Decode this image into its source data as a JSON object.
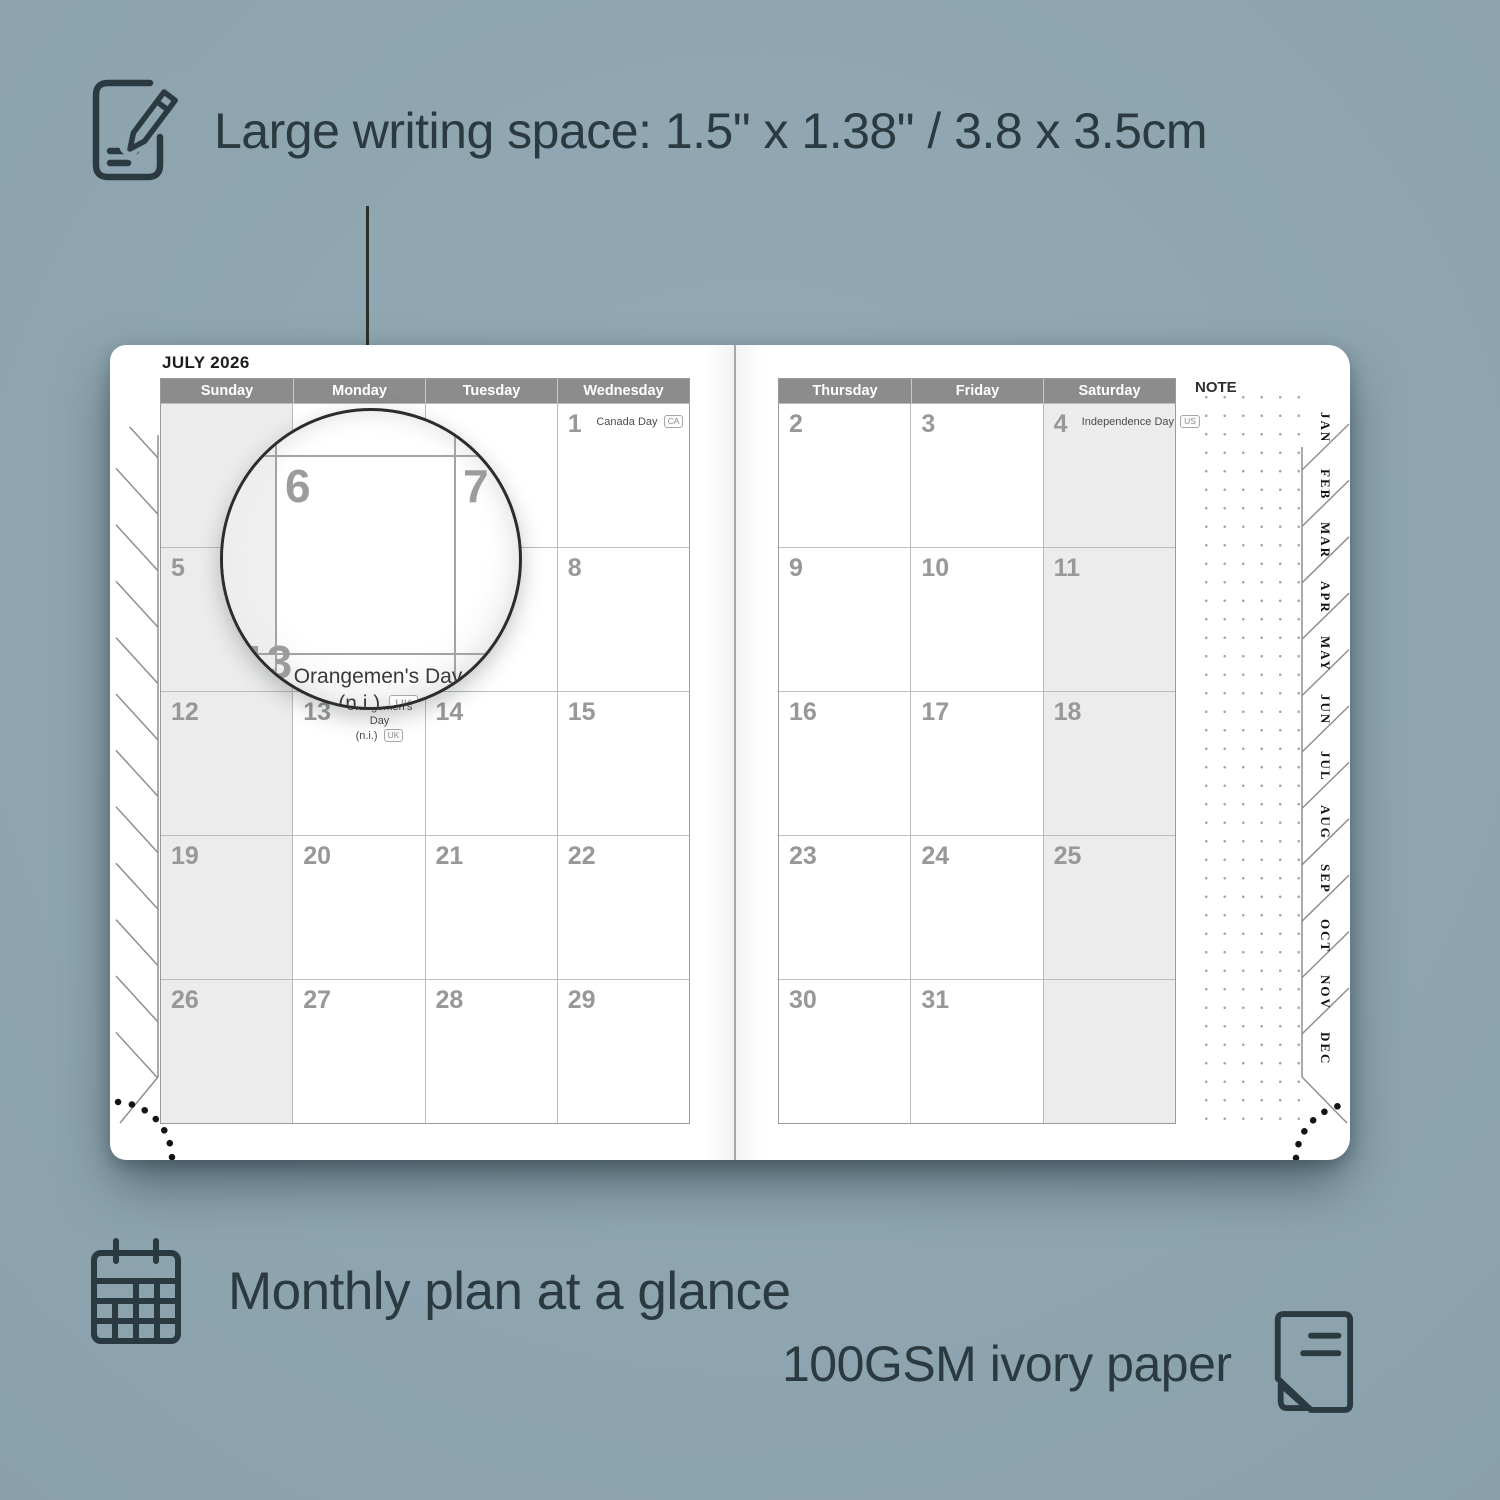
{
  "background_color": "#8ea5b0",
  "callouts": {
    "writing_space_label": "Large writing space: 1.5\" x 1.38\" / 3.8 x 3.5cm",
    "monthly_plan_label": "Monthly plan at a glance",
    "paper_label": "100GSM ivory paper"
  },
  "planner": {
    "month_title": "JULY 2026",
    "note_label": "NOTE",
    "month_tabs": [
      "JAN",
      "FEB",
      "MAR",
      "APR",
      "MAY",
      "JUN",
      "JUL",
      "AUG",
      "SEP",
      "OCT",
      "NOV",
      "DEC"
    ],
    "left_page": {
      "headers": [
        "Sunday",
        "Monday",
        "Tuesday",
        "Wednesday"
      ],
      "shaded_column": 0,
      "rows": [
        [
          null,
          null,
          null,
          {
            "d": "1",
            "holiday": "Canada Day",
            "badge": "CA",
            "layout": "inline"
          }
        ],
        [
          "5",
          "6",
          "7",
          "8"
        ],
        [
          "12",
          {
            "d": "13",
            "holiday": "Orangemen's Day",
            "holiday2": "(n.i.)",
            "badge": "UK",
            "layout": "stacked"
          },
          "14",
          "15"
        ],
        [
          "19",
          "20",
          "21",
          "22"
        ],
        [
          "26",
          "27",
          "28",
          "29"
        ]
      ]
    },
    "right_page": {
      "headers": [
        "Thursday",
        "Friday",
        "Saturday"
      ],
      "shaded_column": 2,
      "rows": [
        [
          "2",
          "3",
          {
            "d": "4",
            "holiday": "Independence Day",
            "badge": "US",
            "layout": "inline"
          }
        ],
        [
          "9",
          "10",
          "11"
        ],
        [
          "16",
          "17",
          "18"
        ],
        [
          "23",
          "24",
          "25"
        ],
        [
          "30",
          "31",
          null
        ]
      ]
    },
    "magnifier": {
      "day_main": "6",
      "day_next": "7",
      "day_below": "13",
      "holiday_line1": "Orangemen's Day",
      "holiday_line2": "(n.i.)",
      "holiday_badge": "UK"
    }
  }
}
